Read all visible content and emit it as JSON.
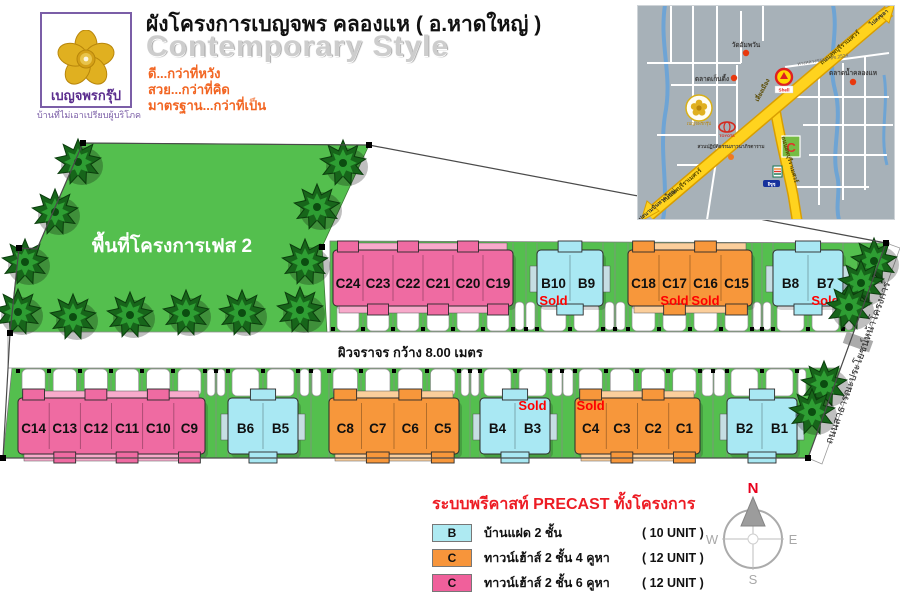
{
  "header": {
    "title": "ผังโครงการเบญจพร  คลองแห ( อ.หาดใหญ่ )",
    "subtitle": "Contemporary Style",
    "slogans": [
      "ดี...กว่าที่หวัง",
      "สวย...กว่าที่คิด",
      "มาตรฐาน...กว่าที่เป็น"
    ],
    "logo": {
      "brand": "เบญจพรกรุ๊ป",
      "tagline": "บ้านที่ไม่เอาเปรียบผู้บริโภค"
    }
  },
  "map": {
    "labels": {
      "temple": "วัดอัมพวัน",
      "market1": "ตลาดเก็นติ้ง",
      "market2": "ตลาดน้ำคลองแห",
      "meditation": "สวนปฏิบัติธรรมภาวนาภิรตาราม",
      "road_main": "ถนนลพบุรีราเมศวร์",
      "road_main2": "ถนนลพบุรีราเมศวร์",
      "road_vertical": "ถนนลพบุรีราเมศวร์",
      "bypass": "เลี่ยงเมือง",
      "rural_road": "ทางหลวงชนบท สข.2524",
      "to_airport": "ไปสนามบินหาดใหญ่",
      "to_songkhla": "ไปสงขลา",
      "toyota": "TOYOTA",
      "shell": "Shell",
      "bigc": "C",
      "isuzu": "อีซูซุ",
      "brand": "เบญจพรกรุ๊ป"
    }
  },
  "site": {
    "phase2_label": "พื้นที่โครงการเฟส 2",
    "road_label": "ผิวจราจร กว้าง 8.00 เมตร",
    "front_road_label": "ถนนสาธารณะประโยชน์หน้าโครงการ",
    "sold_label": "Sold",
    "blocks": [
      {
        "id": "row1-pink",
        "units": [
          "C24",
          "C23",
          "C22",
          "C21",
          "C20",
          "C19"
        ],
        "sold": []
      },
      {
        "id": "row1-b10-b9",
        "units": [
          "B10",
          "B9"
        ],
        "sold": [
          "B10"
        ]
      },
      {
        "id": "row1-orange",
        "units": [
          "C18",
          "C17",
          "C16",
          "C15"
        ],
        "sold": [
          "C17",
          "C16"
        ]
      },
      {
        "id": "row1-b8-b7",
        "units": [
          "B8",
          "B7"
        ],
        "sold": [
          "B7"
        ]
      },
      {
        "id": "row2-pink",
        "units": [
          "C14",
          "C13",
          "C12",
          "C11",
          "C10",
          "C9"
        ],
        "sold": []
      },
      {
        "id": "row2-b6-b5",
        "units": [
          "B6",
          "B5"
        ],
        "sold": []
      },
      {
        "id": "row2-orange-a",
        "units": [
          "C8",
          "C7",
          "C6",
          "C5"
        ],
        "sold": []
      },
      {
        "id": "row2-b4-b3",
        "units": [
          "B4",
          "B3"
        ],
        "sold": [
          "B3"
        ]
      },
      {
        "id": "row2-orange-b",
        "units": [
          "C4",
          "C3",
          "C2",
          "C1"
        ],
        "sold": [
          "C4"
        ]
      },
      {
        "id": "row2-b2-b1",
        "units": [
          "B2",
          "B1"
        ],
        "sold": []
      }
    ]
  },
  "legend": {
    "title": "ระบบพรีคาสท์ PRECAST ทั้งโครงการ",
    "items": [
      {
        "key": "B",
        "color": "#AEEAF2",
        "desc": "บ้านแฝด  2 ชั้น",
        "count": "( 10 UNIT )"
      },
      {
        "key": "C",
        "color": "#F7953B",
        "desc": "ทาวน์เฮ้าส์ 2 ชั้น 4 คูหา",
        "count": "( 12 UNIT )"
      },
      {
        "key": "C",
        "color": "#F0609B",
        "desc": "ทาวน์เฮ้าส์ 2 ชั้น 6 คูหา",
        "count": "( 12 UNIT )"
      }
    ]
  },
  "compass": {
    "n": "N",
    "s": "S",
    "e": "E",
    "w": "W"
  },
  "colors": {
    "lot_green": "#54BF4E",
    "pink": "#EF6BA2",
    "orange": "#F7973B",
    "cyan": "#A9E8F3",
    "sold_red": "#FF0000",
    "legend_red": "#ED1C24",
    "slogan_orange": "#F26522",
    "map_bg": "#A7B1B8",
    "map_road_yellow": "#FFD31E",
    "logo_purple": "#7B5EA7",
    "logo_gold": "#E0B020"
  }
}
